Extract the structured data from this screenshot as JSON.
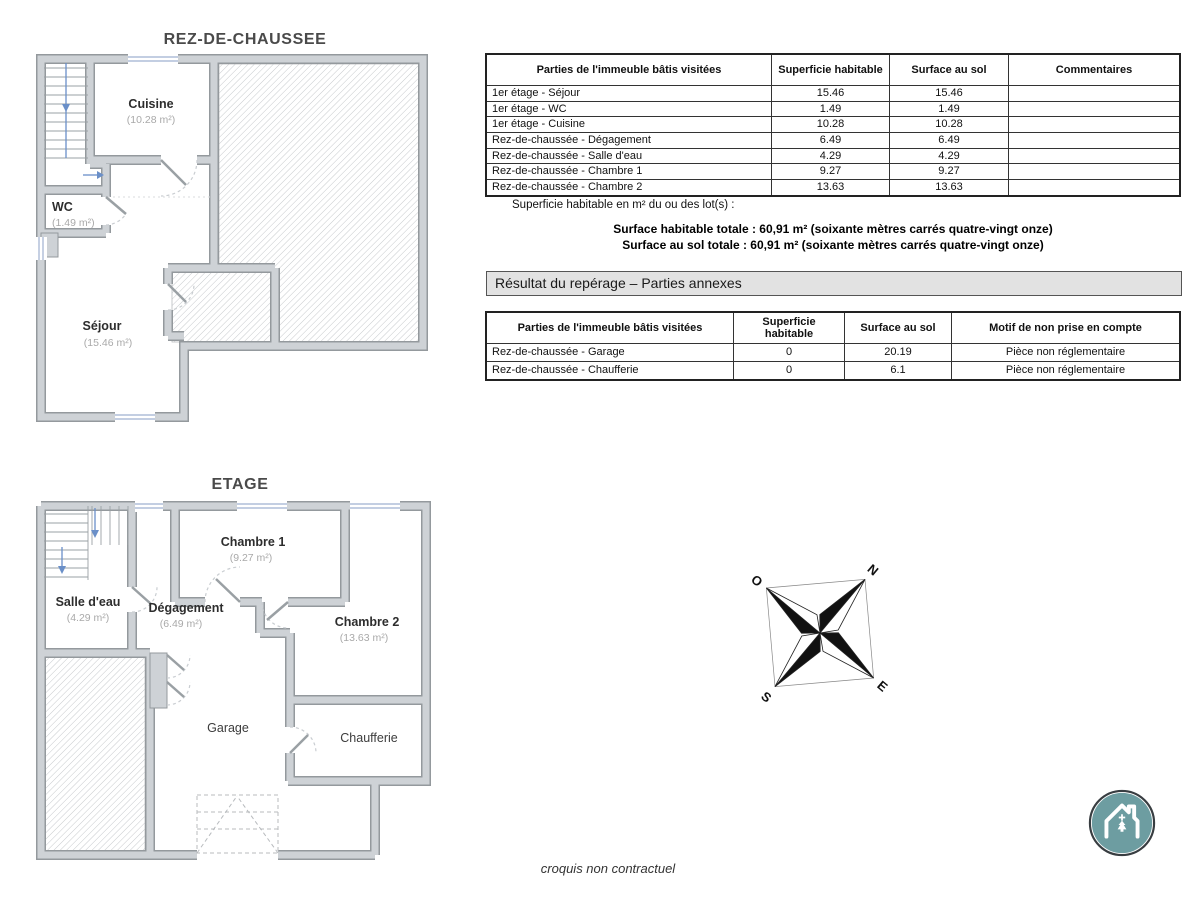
{
  "plans": {
    "ground": {
      "title": "REZ-DE-CHAUSSEE",
      "rooms": {
        "cuisine": {
          "name": "Cuisine",
          "area": "(10.28 m²)"
        },
        "wc": {
          "name": "WC",
          "area": "(1.49 m²)"
        },
        "sejour": {
          "name": "Séjour",
          "area": "(15.46 m²)"
        }
      }
    },
    "floor": {
      "title": "ETAGE",
      "rooms": {
        "chambre1": {
          "name": "Chambre 1",
          "area": "(9.27 m²)"
        },
        "salle_eau": {
          "name": "Salle d'eau",
          "area": "(4.29 m²)"
        },
        "degagement": {
          "name": "Dégagement",
          "area": "(6.49 m²)"
        },
        "chambre2": {
          "name": "Chambre 2",
          "area": "(13.63 m²)"
        },
        "garage": {
          "name": "Garage"
        },
        "chaufferie": {
          "name": "Chaufferie"
        }
      }
    }
  },
  "visited_table": {
    "headers": [
      "Parties de l'immeuble bâtis visitées",
      "Superficie habitable",
      "Surface au sol",
      "Commentaires"
    ],
    "rows": [
      [
        "1er étage - Séjour",
        "15.46",
        "15.46",
        ""
      ],
      [
        "1er étage - WC",
        "1.49",
        "1.49",
        ""
      ],
      [
        "1er étage - Cuisine",
        "10.28",
        "10.28",
        ""
      ],
      [
        "Rez-de-chaussée - Dégagement",
        "6.49",
        "6.49",
        ""
      ],
      [
        "Rez-de-chaussée - Salle d'eau",
        "4.29",
        "4.29",
        ""
      ],
      [
        "Rez-de-chaussée - Chambre 1",
        "9.27",
        "9.27",
        ""
      ],
      [
        "Rez-de-chaussée - Chambre 2",
        "13.63",
        "13.63",
        ""
      ]
    ]
  },
  "surface_note": "Superficie habitable en m² du ou des lot(s) :",
  "totals": {
    "habitable": "Surface habitable totale : 60,91 m² (soixante mètres carrés quatre-vingt onze)",
    "sol": "Surface au sol totale : 60,91 m² (soixante mètres carrés quatre-vingt onze)"
  },
  "annex_section": {
    "title": "Résultat du repérage – Parties annexes",
    "table": {
      "headers": [
        "Parties de l'immeuble bâtis visitées",
        "Superficie habitable",
        "Surface au sol",
        "Motif de non prise en compte"
      ],
      "rows": [
        [
          "Rez-de-chaussée - Garage",
          "0",
          "20.19",
          "Pièce non réglementaire"
        ],
        [
          "Rez-de-chaussée - Chaufferie",
          "0",
          "6.1",
          "Pièce non réglementaire"
        ]
      ]
    }
  },
  "compass": {
    "north": "N",
    "south": "S",
    "east": "E",
    "west": "O"
  },
  "footer": {
    "note": "croquis non contractuel"
  },
  "colors": {
    "logo_teal": "#6d9da1",
    "wall_fill": "#ced2d6",
    "wall_edge": "#94999d",
    "hatch_line": "#c7cacd",
    "window_blue": "#9fb0d0",
    "arrow_blue": "#6a8fc8",
    "section_bg": "#e2e2e2"
  }
}
